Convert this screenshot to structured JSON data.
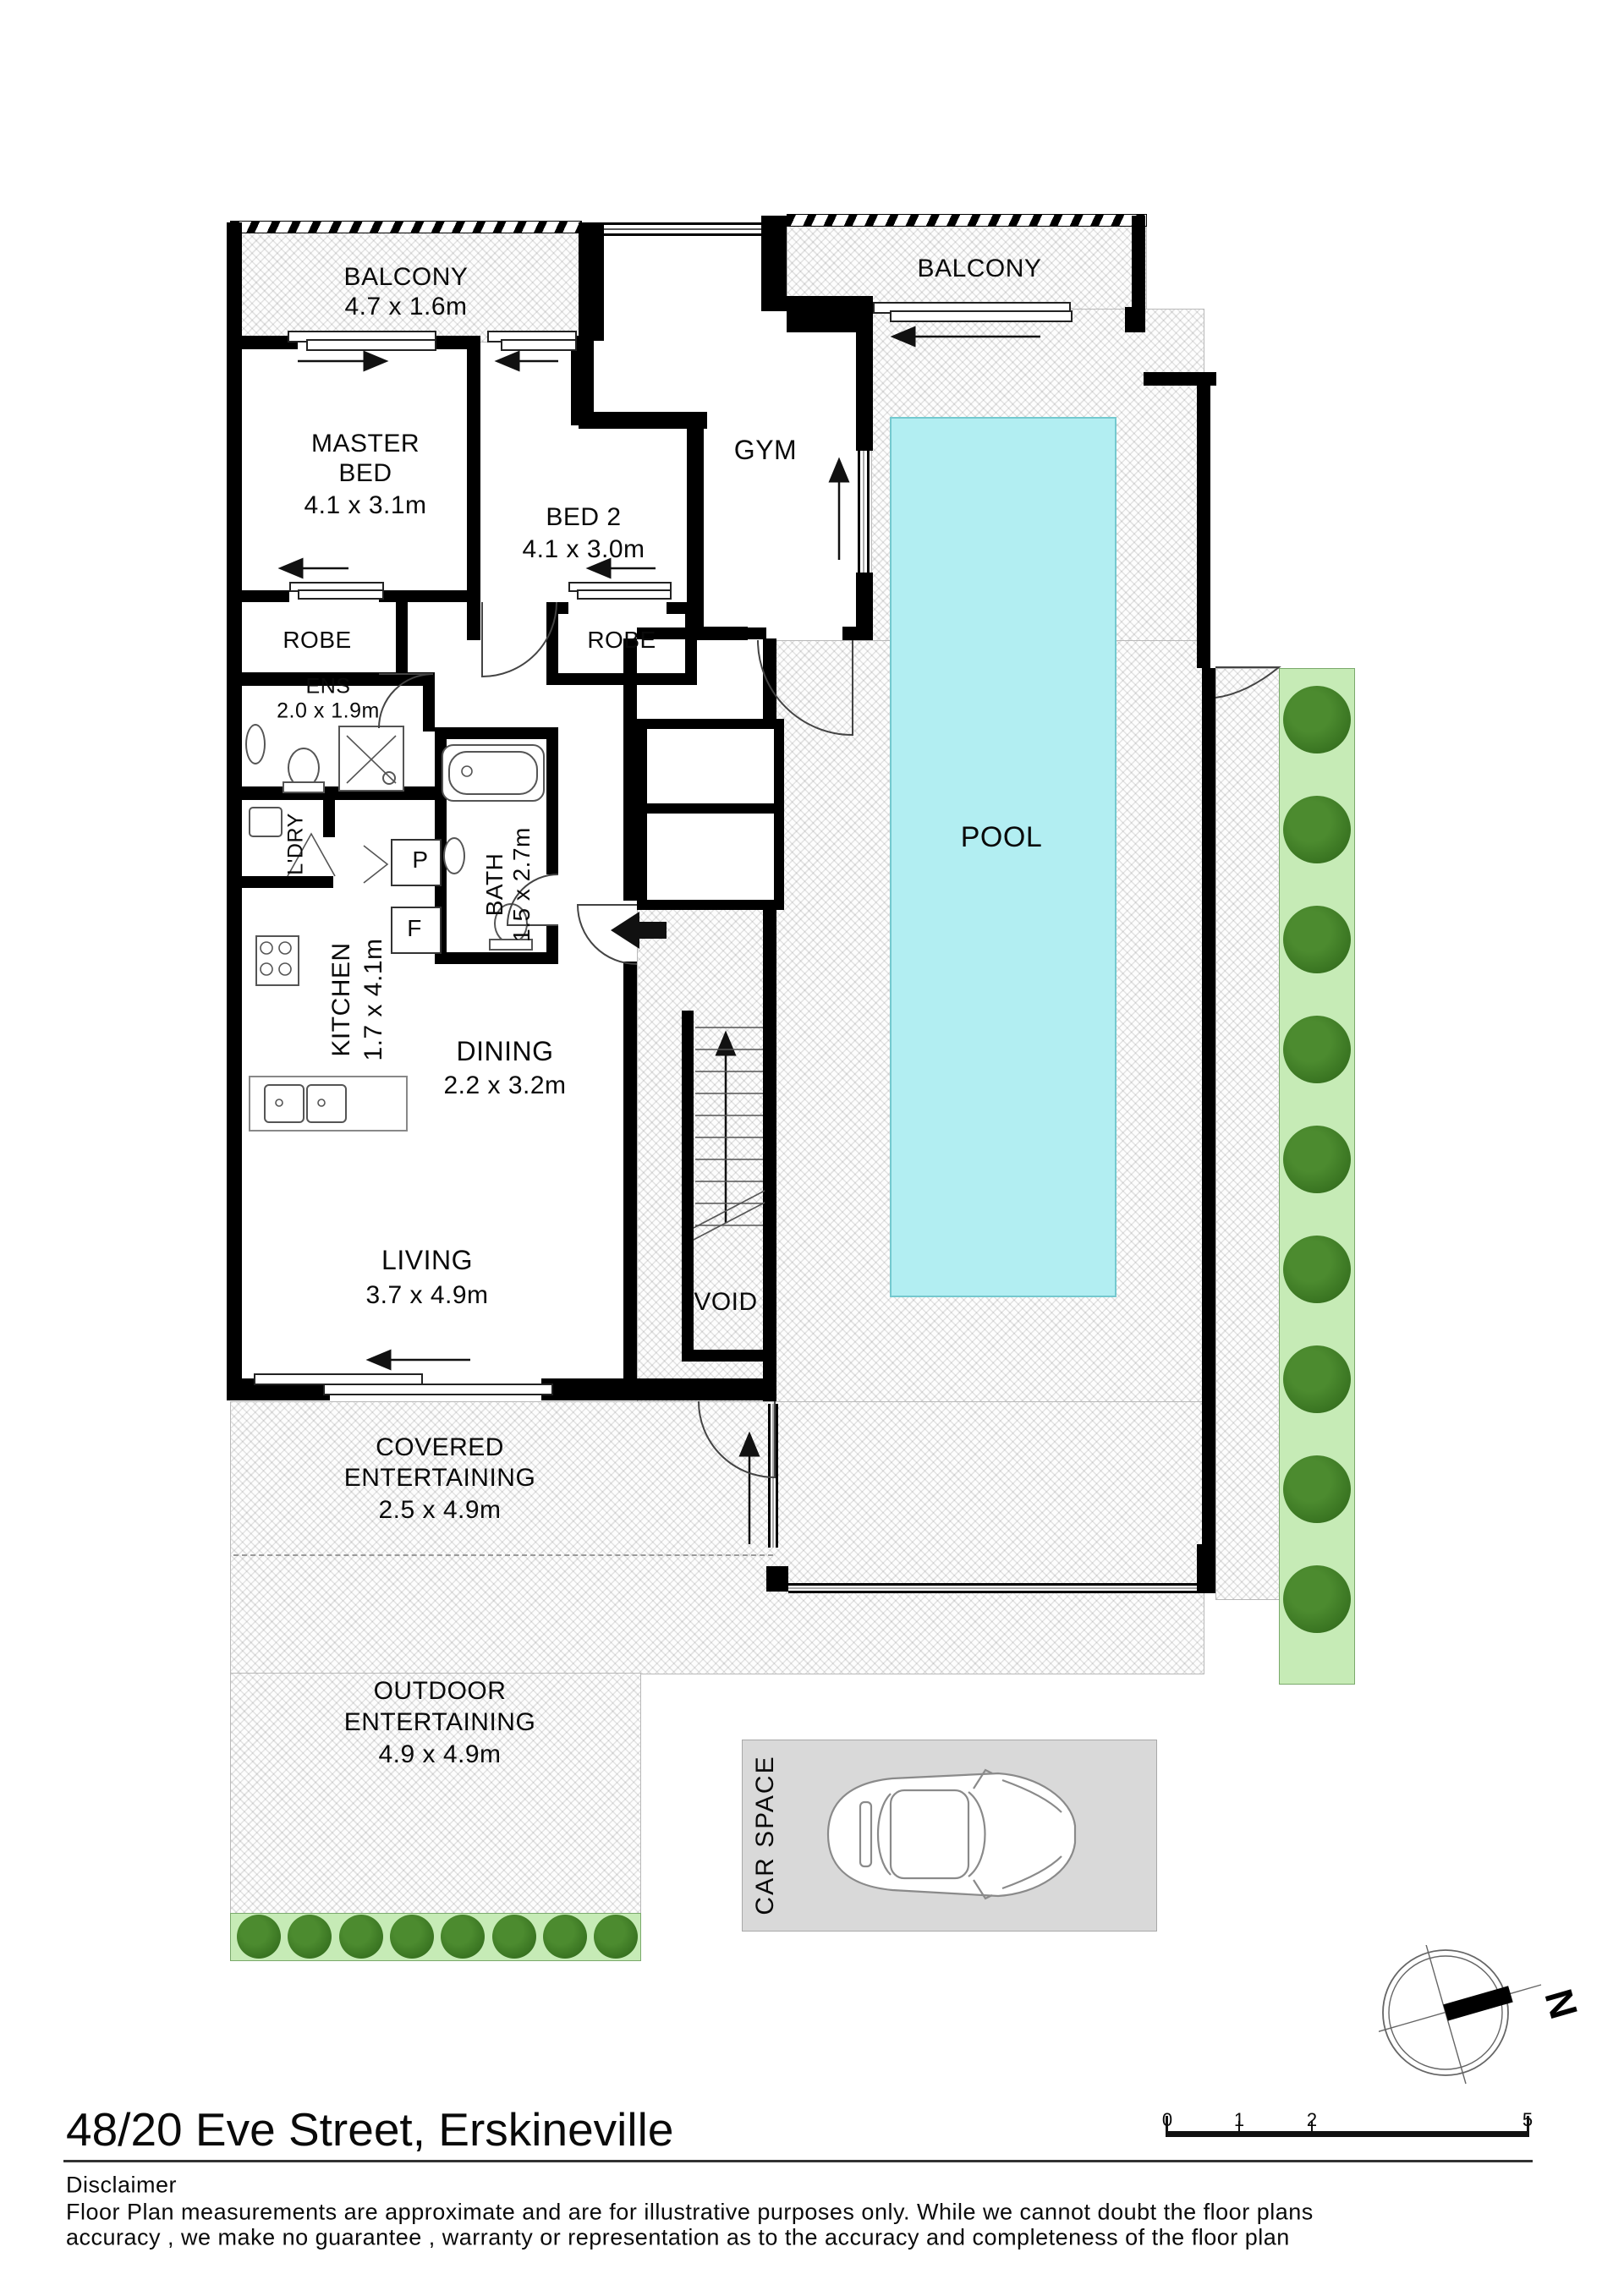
{
  "plan": {
    "rooms": {
      "balcony_left": {
        "name": "BALCONY",
        "dims": "4.7 x 1.6m"
      },
      "balcony_right": {
        "name": "BALCONY"
      },
      "master_bed": {
        "line1": "MASTER",
        "line2": "BED",
        "dims": "4.1 x 3.1m"
      },
      "bed2": {
        "name": "BED 2",
        "dims": "4.1 x 3.0m"
      },
      "gym": {
        "name": "GYM"
      },
      "robe_left": {
        "name": "ROBE"
      },
      "robe_right": {
        "name": "ROBE"
      },
      "ensuite": {
        "name": "ENS",
        "dims": "2.0 x 1.9m"
      },
      "laundry": {
        "name": "L'DRY"
      },
      "pantry": {
        "name": "P"
      },
      "fridge": {
        "name": "F"
      },
      "bath": {
        "name": "BATH",
        "dims": "1.5 x 2.7m"
      },
      "kitchen": {
        "name": "KITCHEN",
        "dims": "1.7 x 4.1m"
      },
      "dining": {
        "name": "DINING",
        "dims": "2.2 x 3.2m"
      },
      "living": {
        "name": "LIVING",
        "dims": "3.7 x 4.9m"
      },
      "void": {
        "name": "VOID"
      },
      "pool": {
        "name": "POOL"
      },
      "covered_entertaining": {
        "line1": "COVERED",
        "line2": "ENTERTAINING",
        "dims": "2.5 x 4.9m"
      },
      "outdoor_entertaining": {
        "line1": "OUTDOOR",
        "line2": "ENTERTAINING",
        "dims": "4.9 x 4.9m"
      },
      "car_space": {
        "name": "CAR SPACE"
      }
    },
    "landscaping": {
      "right_tree_count": 9,
      "bottom_tree_count": 8
    },
    "compass": {
      "north_label": "N"
    },
    "scale_bar": {
      "ticks": [
        "0",
        "1",
        "2",
        "5"
      ]
    },
    "colors": {
      "wall": "#000000",
      "pool_fill": "#b2eef2",
      "pool_edge": "#74c9cf",
      "tree": "#3a7522",
      "tree_strip": "#c6ebb6",
      "car_space_bg": "#d9d9d9"
    }
  },
  "footer": {
    "title": "48/20 Eve Street, Erskineville",
    "disclaimer_heading": "Disclaimer",
    "disclaimer_line1": "Floor Plan measurements are approximate and are for illustrative purposes only. While we cannot doubt the floor plans",
    "disclaimer_line2": "accuracy , we make no guarantee , warranty or representation as to the accuracy and completeness of the floor plan"
  }
}
